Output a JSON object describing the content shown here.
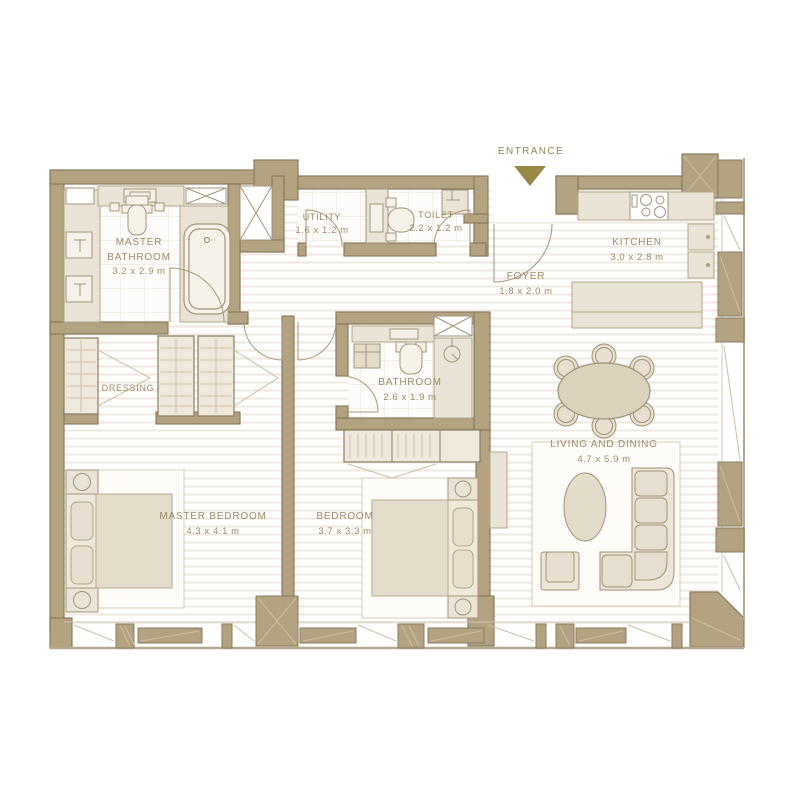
{
  "entrance": {
    "label": "ENTRANCE"
  },
  "rooms": {
    "master_bathroom": {
      "name": "MASTER BATHROOM",
      "dims": "3.2 x 2.9 m"
    },
    "utility": {
      "name": "UTILITY",
      "dims": "1.6 x 1.2 m"
    },
    "toilet": {
      "name": "TOILET",
      "dims": "2.2 x 1.2 m"
    },
    "kitchen": {
      "name": "KITCHEN",
      "dims": "3.0 x 2.8 m"
    },
    "foyer": {
      "name": "FOYER",
      "dims": "1.8 x 2.0 m"
    },
    "dressing": {
      "name": "DRESSING"
    },
    "bathroom": {
      "name": "BATHROOM",
      "dims": "2.6 x 1.9 m"
    },
    "master_bedroom": {
      "name": "MASTER BEDROOM",
      "dims": "4.3 x 4.1 m"
    },
    "bedroom": {
      "name": "BEDROOM",
      "dims": "3.7 x 3.3 m"
    },
    "living_dining": {
      "name": "LIVING AND DINING",
      "dims": "4.7 x 5.9 m"
    }
  },
  "colors": {
    "wall_fill": "#b3a381",
    "wall_stroke": "#8a7b5e",
    "fixture_fill": "#eae4d6",
    "furniture_fill": "#e6dfcf",
    "label_text": "#9c8b68",
    "entrance_accent": "#998949",
    "floor_stripe": "#efeae1",
    "tile_line": "#e9e3d7"
  }
}
